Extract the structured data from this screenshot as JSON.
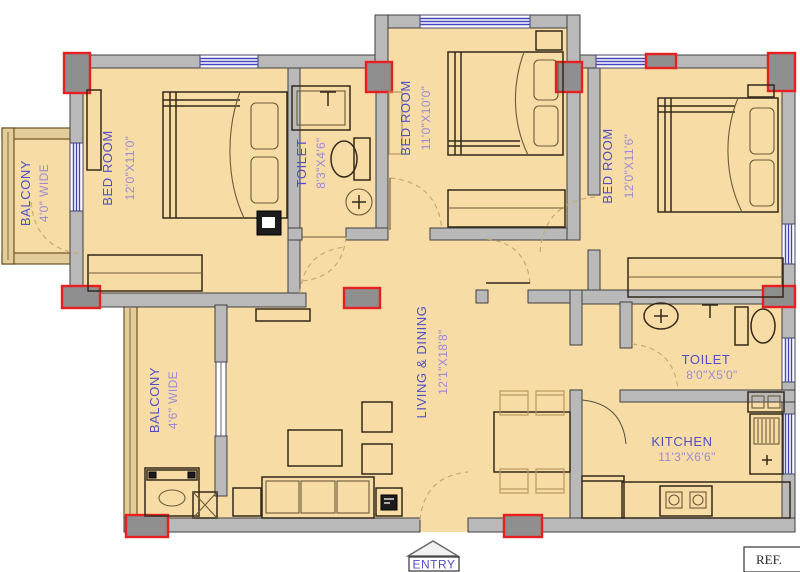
{
  "plan": {
    "title": "apartment-floor-plan",
    "rooms": [
      {
        "id": "bedroom-1",
        "name": "BED ROOM",
        "size": "12'0\"X11'0\""
      },
      {
        "id": "toilet-1",
        "name": "TOILET",
        "size": "8'3\"X4'6\""
      },
      {
        "id": "bedroom-2",
        "name": "BED ROOM",
        "size": "11'0\"X10'0\""
      },
      {
        "id": "bedroom-3",
        "name": "BED ROOM",
        "size": "12'0\"X11'6\""
      },
      {
        "id": "balcony-1",
        "name": "BALCONY",
        "size": "4'0\" WIDE"
      },
      {
        "id": "balcony-2",
        "name": "BALCONY",
        "size": "4'6\" WIDE"
      },
      {
        "id": "living-dining",
        "name": "LIVING & DINING",
        "size": "12'1\"X18'8\""
      },
      {
        "id": "toilet-2",
        "name": "TOILET",
        "size": "8'0\"X5'0\""
      },
      {
        "id": "kitchen",
        "name": "KITCHEN",
        "size": "11'3\"X6'6\""
      }
    ],
    "entry_label": "ENTRY",
    "ref_label": "REF.",
    "colors": {
      "floor": "#F8DCA6",
      "wall": "#B9B9B9",
      "column_accent": "#E62020",
      "window": "#4444BB",
      "label": "#4F4FC4",
      "label_size": "#9B8AD6"
    }
  }
}
